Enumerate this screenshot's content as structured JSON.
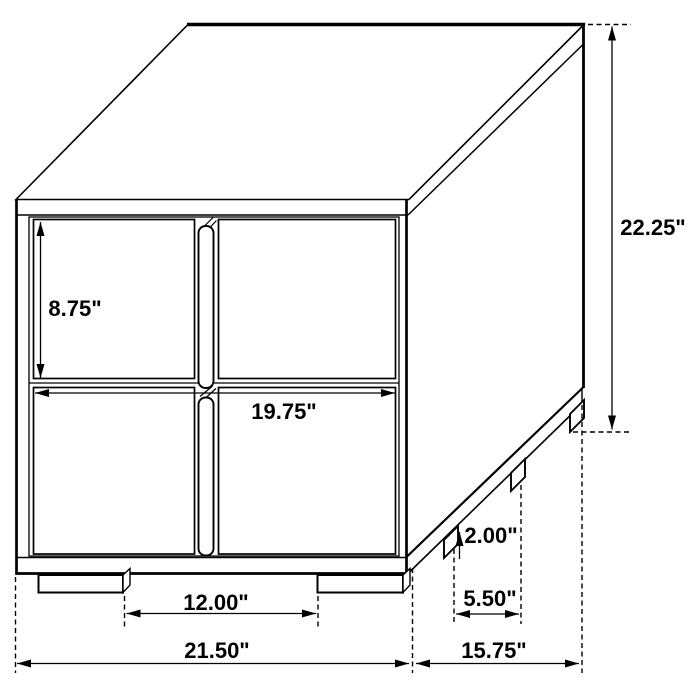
{
  "diagram": {
    "type": "furniture-dimension-line-drawing",
    "unit": "inches",
    "colors": {
      "line": "#000000",
      "background": "#ffffff",
      "text": "#000000"
    },
    "dims": {
      "height": "22.25\"",
      "upper_drawer_height": "8.75\"",
      "drawer_front_width": "19.75\"",
      "foot_height": "2.00\"",
      "side_foot_spacing": "5.50\"",
      "front_foot_spacing": "12.00\"",
      "overall_width": "21.50\"",
      "overall_depth": "15.75\""
    }
  }
}
